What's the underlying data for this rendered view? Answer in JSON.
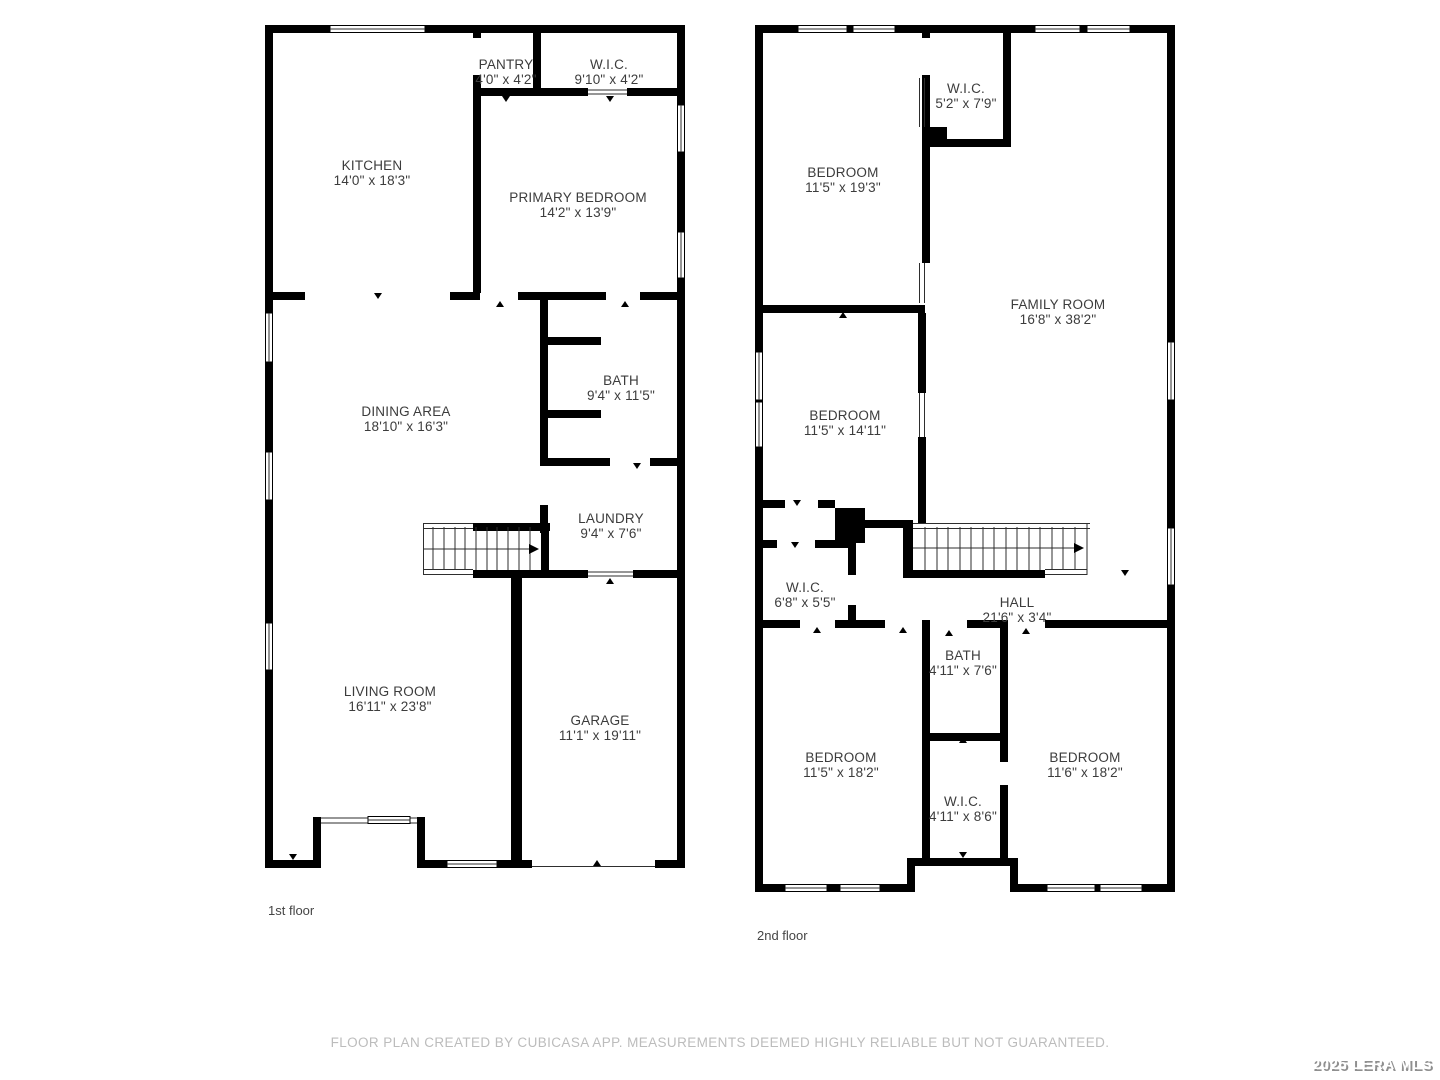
{
  "page": {
    "footer": "FLOOR PLAN CREATED BY CUBICASA APP. MEASUREMENTS DEEMED HIGHLY RELIABLE BUT NOT GUARANTEED.",
    "watermark": "2025 LERA MLS"
  },
  "floors": [
    {
      "label": "1st floor",
      "rooms": [
        {
          "name": "KITCHEN",
          "dims": "14'0\" x 18'3\""
        },
        {
          "name": "PANTRY",
          "dims": "4'0\" x 4'2\""
        },
        {
          "name": "W.I.C.",
          "dims": "9'10\" x 4'2\""
        },
        {
          "name": "PRIMARY BEDROOM",
          "dims": "14'2\" x 13'9\""
        },
        {
          "name": "DINING AREA",
          "dims": "18'10\" x 16'3\""
        },
        {
          "name": "BATH",
          "dims": "9'4\" x 11'5\""
        },
        {
          "name": "LAUNDRY",
          "dims": "9'4\" x 7'6\""
        },
        {
          "name": "LIVING ROOM",
          "dims": "16'11\" x 23'8\""
        },
        {
          "name": "GARAGE",
          "dims": "11'1\" x 19'11\""
        }
      ]
    },
    {
      "label": "2nd floor",
      "rooms": [
        {
          "name": "BEDROOM",
          "dims": "11'5\" x 19'3\""
        },
        {
          "name": "W.I.C.",
          "dims": "5'2\" x 7'9\""
        },
        {
          "name": "FAMILY ROOM",
          "dims": "16'8\" x 38'2\""
        },
        {
          "name": "BEDROOM",
          "dims": "11'5\" x 14'11\""
        },
        {
          "name": "W.I.C.",
          "dims": "6'8\" x 5'5\""
        },
        {
          "name": "HALL",
          "dims": "21'6\" x 3'4\""
        },
        {
          "name": "BATH",
          "dims": "4'11\" x 7'6\""
        },
        {
          "name": "BEDROOM",
          "dims": "11'5\" x 18'2\""
        },
        {
          "name": "W.I.C.",
          "dims": "4'11\" x 8'6\""
        },
        {
          "name": "BEDROOM",
          "dims": "11'6\" x 18'2\""
        }
      ]
    }
  ]
}
